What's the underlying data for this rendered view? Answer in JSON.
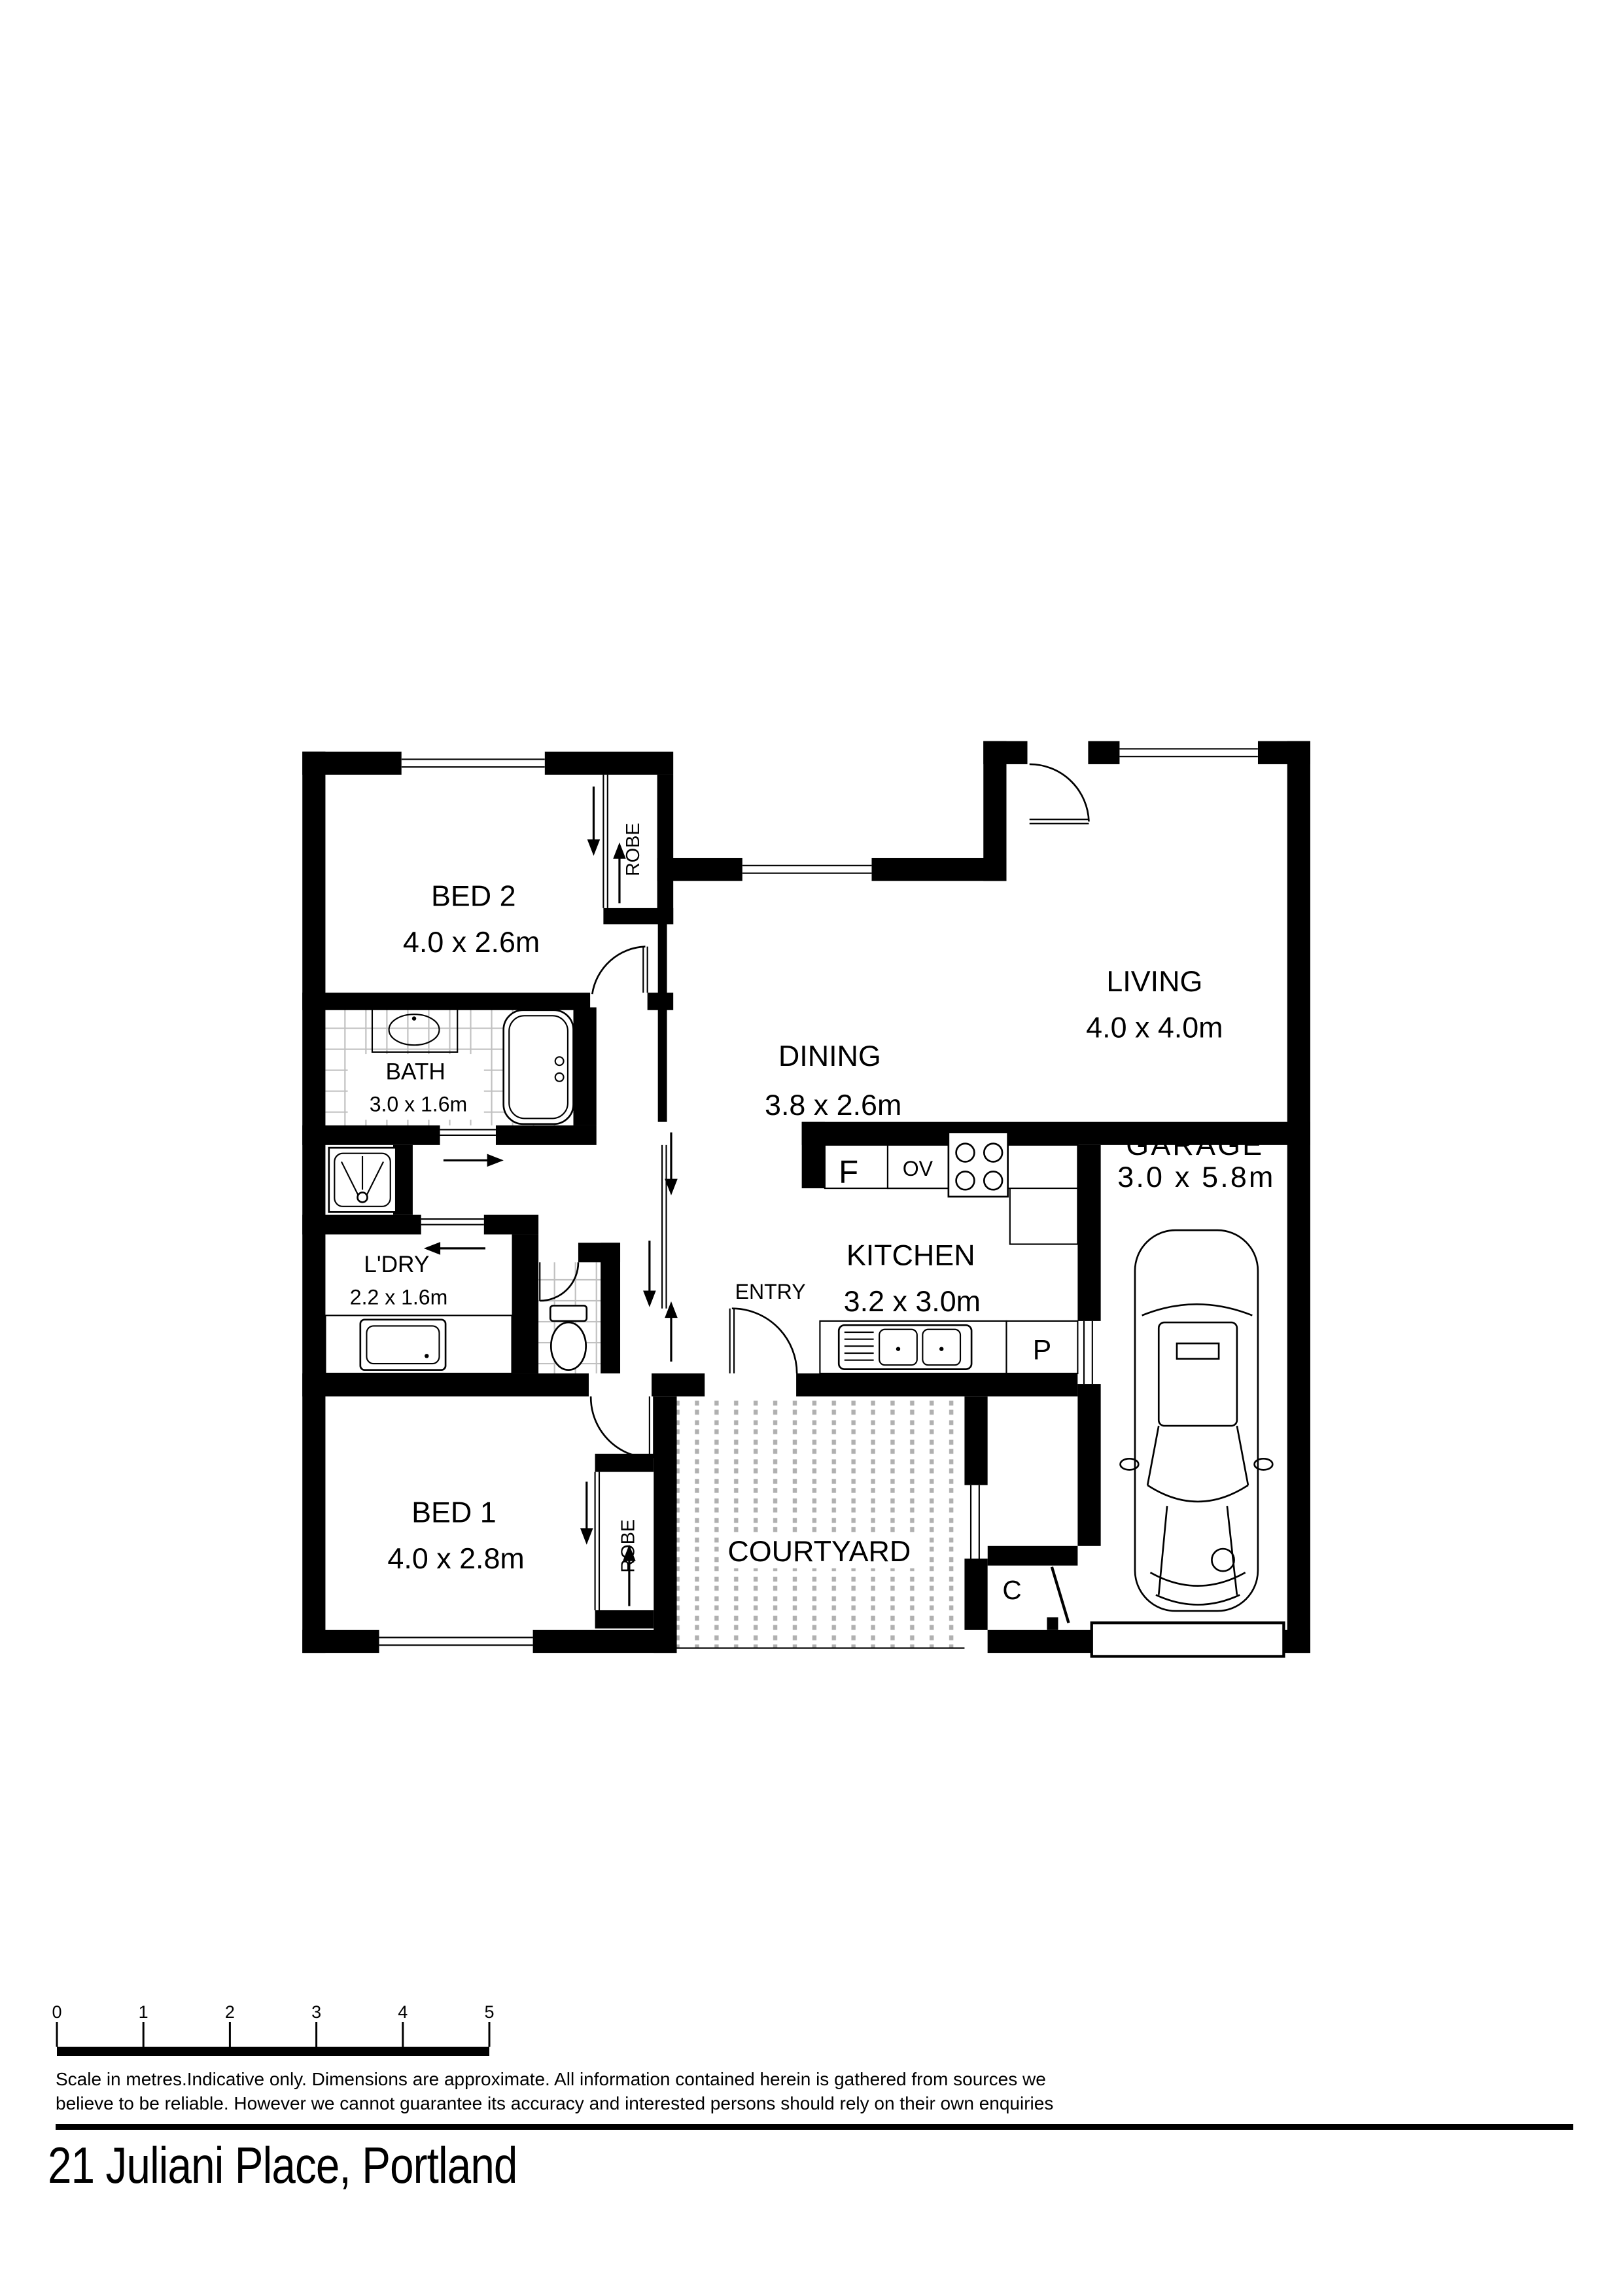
{
  "address": "21 Juliani Place, Portland",
  "floorplan": {
    "rooms": [
      {
        "name": "BED 2",
        "dims": "4.0 x 2.6m"
      },
      {
        "name": "DINING",
        "dims": "3.8 x 2.6m"
      },
      {
        "name": "LIVING",
        "dims": "4.0 x 4.0m"
      },
      {
        "name": "BATH",
        "dims": "3.0 x 1.6m"
      },
      {
        "name": "L'DRY",
        "dims": "2.2 x 1.6m"
      },
      {
        "name": "KITCHEN",
        "dims": "3.2 x 3.0m"
      },
      {
        "name": "GARAGE",
        "dims": "3.0 x 5.8m"
      },
      {
        "name": "BED 1",
        "dims": "4.0 x 2.8m"
      },
      {
        "name": "COURTYARD",
        "dims": ""
      }
    ],
    "labels": {
      "robe": "ROBE",
      "entry": "ENTRY",
      "fridge": "F",
      "oven": "OV",
      "pantry": "P",
      "cupboard": "C"
    },
    "colors": {
      "wall": "#000000",
      "tile_line": "#c0c0c0",
      "courtyard_dot": "#b0b0b0"
    }
  },
  "scalebar": {
    "ticks": [
      "0",
      "1",
      "2",
      "3",
      "4",
      "5"
    ],
    "caption_line1": "Scale in metres.Indicative only. Dimensions are approximate. All information contained herein is gathered from sources we",
    "caption_line2": "believe to be reliable. However we cannot guarantee its accuracy and interested persons should rely on their own enquiries"
  }
}
